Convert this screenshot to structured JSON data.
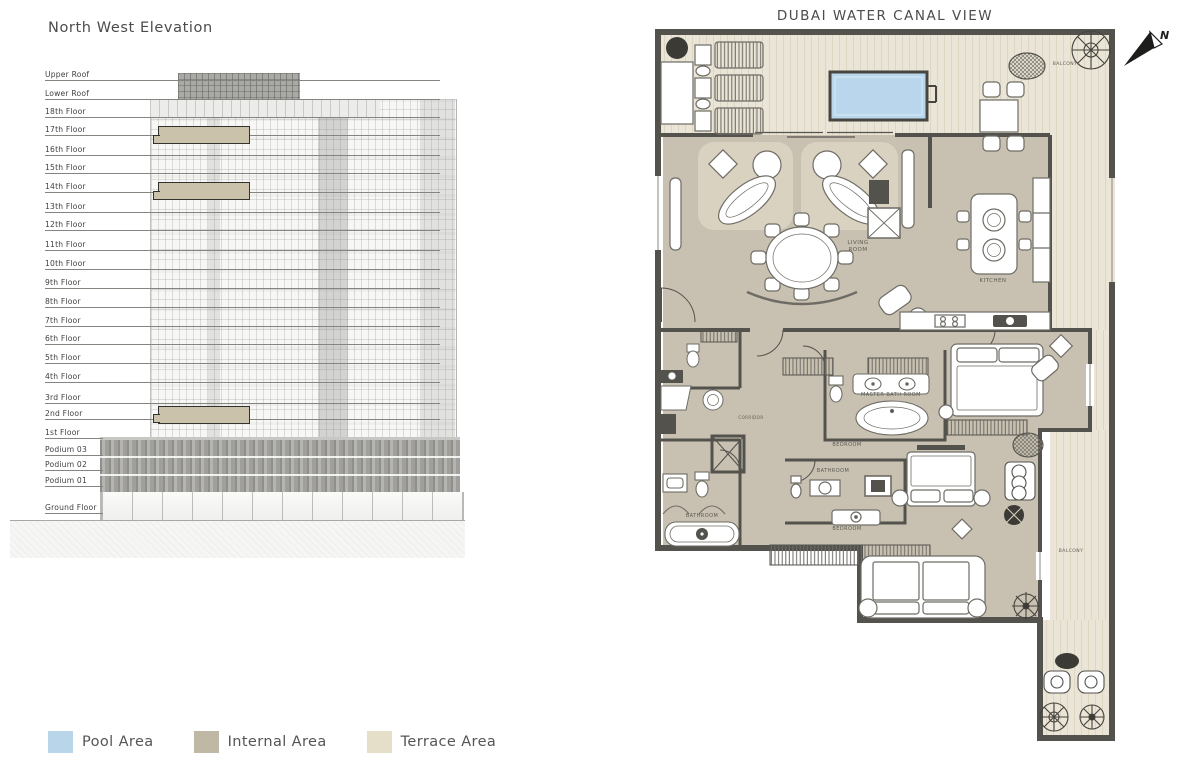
{
  "elevation": {
    "title": "North West Elevation",
    "floors": [
      "Upper Roof",
      "Lower Roof",
      "18th Floor",
      "17th Floor",
      "16th Floor",
      "15th Floor",
      "14th Floor",
      "13th Floor",
      "12th Floor",
      "11th Floor",
      "10th Floor",
      "9th Floor",
      "8th Floor",
      "7th Floor",
      "6th Floor",
      "5th Floor",
      "4th Floor",
      "3rd Floor",
      "2nd Floor",
      "1st Floor",
      "Podium 03",
      "Podium 02",
      "Podium 01",
      "Ground Floor"
    ],
    "highlighted_floors": [
      "17th Floor",
      "14th Floor",
      "2nd Floor"
    ]
  },
  "plan": {
    "title": "DUBAI WATER CANAL VIEW",
    "compass": "N",
    "rooms": {
      "living_room": "LIVING ROOM",
      "kitchen": "KITCHEN",
      "master_bathroom": "MASTER BATH ROOM",
      "bedroom_mid": "BEDROOM",
      "bedroom_bottom": "BEDROOM",
      "bathroom_mid": "BATHROOM",
      "bathroom_left": "BATHROOM",
      "balcony_top": "BALCONY",
      "balcony_right": "BALCONY",
      "corridor": "CORRIDOR"
    },
    "area_colors": {
      "pool": "#b9d6ec",
      "internal": "#c8c1b1",
      "terrace": "#e8e3d4"
    }
  },
  "legend": {
    "items": [
      {
        "label": "Pool Area",
        "color": "#b9d5ea"
      },
      {
        "label": "Internal Area",
        "color": "#bfb8a4"
      },
      {
        "label": "Terrace Area",
        "color": "#e5dfca"
      }
    ]
  }
}
